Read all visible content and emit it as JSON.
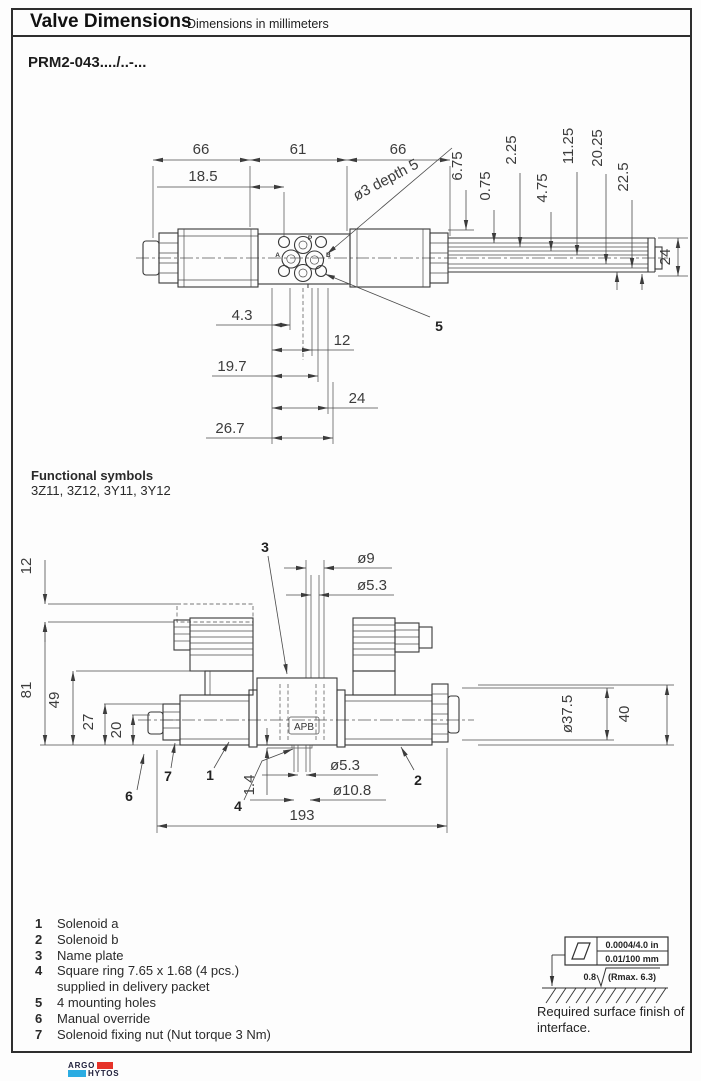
{
  "header": {
    "title": "Valve Dimensions",
    "subtitle": "Dimensions in millimeters"
  },
  "model": "PRM2-043..../..-...",
  "functional": {
    "label": "Functional symbols",
    "codes": "3Z11, 3Z12, 3Y11, 3Y12"
  },
  "top": {
    "h66a": "66",
    "h61": "61",
    "h66b": "66",
    "h18_5": "18.5",
    "hole_note": "ø3 depth 5",
    "v6_75": "6.75",
    "v0_75": "0.75",
    "v2_25": "2.25",
    "v4_75": "4.75",
    "v11_25": "11.25",
    "v20_25": "20.25",
    "v22_5": "22.5",
    "v24": "24",
    "b4_3": "4.3",
    "b12": "12",
    "b19_7": "19.7",
    "b24": "24",
    "b26_7": "26.7",
    "port_p": "P",
    "port_a": "A",
    "port_b": "B",
    "port_t": "T",
    "callout_5": "5"
  },
  "bottom": {
    "l12": "12",
    "l81": "81",
    "l49": "49",
    "l27": "27",
    "l20": "20",
    "t_d9": "ø9",
    "t_d5_3": "ø5.3",
    "r_d37_5": "ø37.5",
    "r40": "40",
    "b1_4": "1.4",
    "b_d5_3": "ø5.3",
    "b_d10_8": "ø10.8",
    "b193": "193",
    "apb": "APB",
    "c1": "1",
    "c2": "2",
    "c3": "3",
    "c4": "4",
    "c6": "6",
    "c7": "7"
  },
  "legend": {
    "items": [
      {
        "num": "1",
        "text": "Solenoid a"
      },
      {
        "num": "2",
        "text": "Solenoid b"
      },
      {
        "num": "3",
        "text": "Name plate"
      },
      {
        "num": "4",
        "text": "Square ring 7.65 x 1.68 (4 pcs.)",
        "text2": "supplied in delivery packet"
      },
      {
        "num": "5",
        "text": "4 mounting holes"
      },
      {
        "num": "6",
        "text": "Manual override"
      },
      {
        "num": "7",
        "text": "Solenoid fixing nut (Nut torque 3 Nm)"
      }
    ]
  },
  "surface_finish": {
    "flatness_in": "0.0004/4.0 in",
    "flatness_mm": "0.01/100 mm",
    "roughness": "0.8",
    "rmax": "(Rmax. 6.3)",
    "caption1": "Required surface finish of",
    "caption2": "interface."
  },
  "logo": {
    "argo": "ARGO",
    "hytos": "HYTOS"
  },
  "colors": {
    "logo_red": "#e63329",
    "logo_blue": "#2bace2",
    "line": "#3f3f3f"
  }
}
